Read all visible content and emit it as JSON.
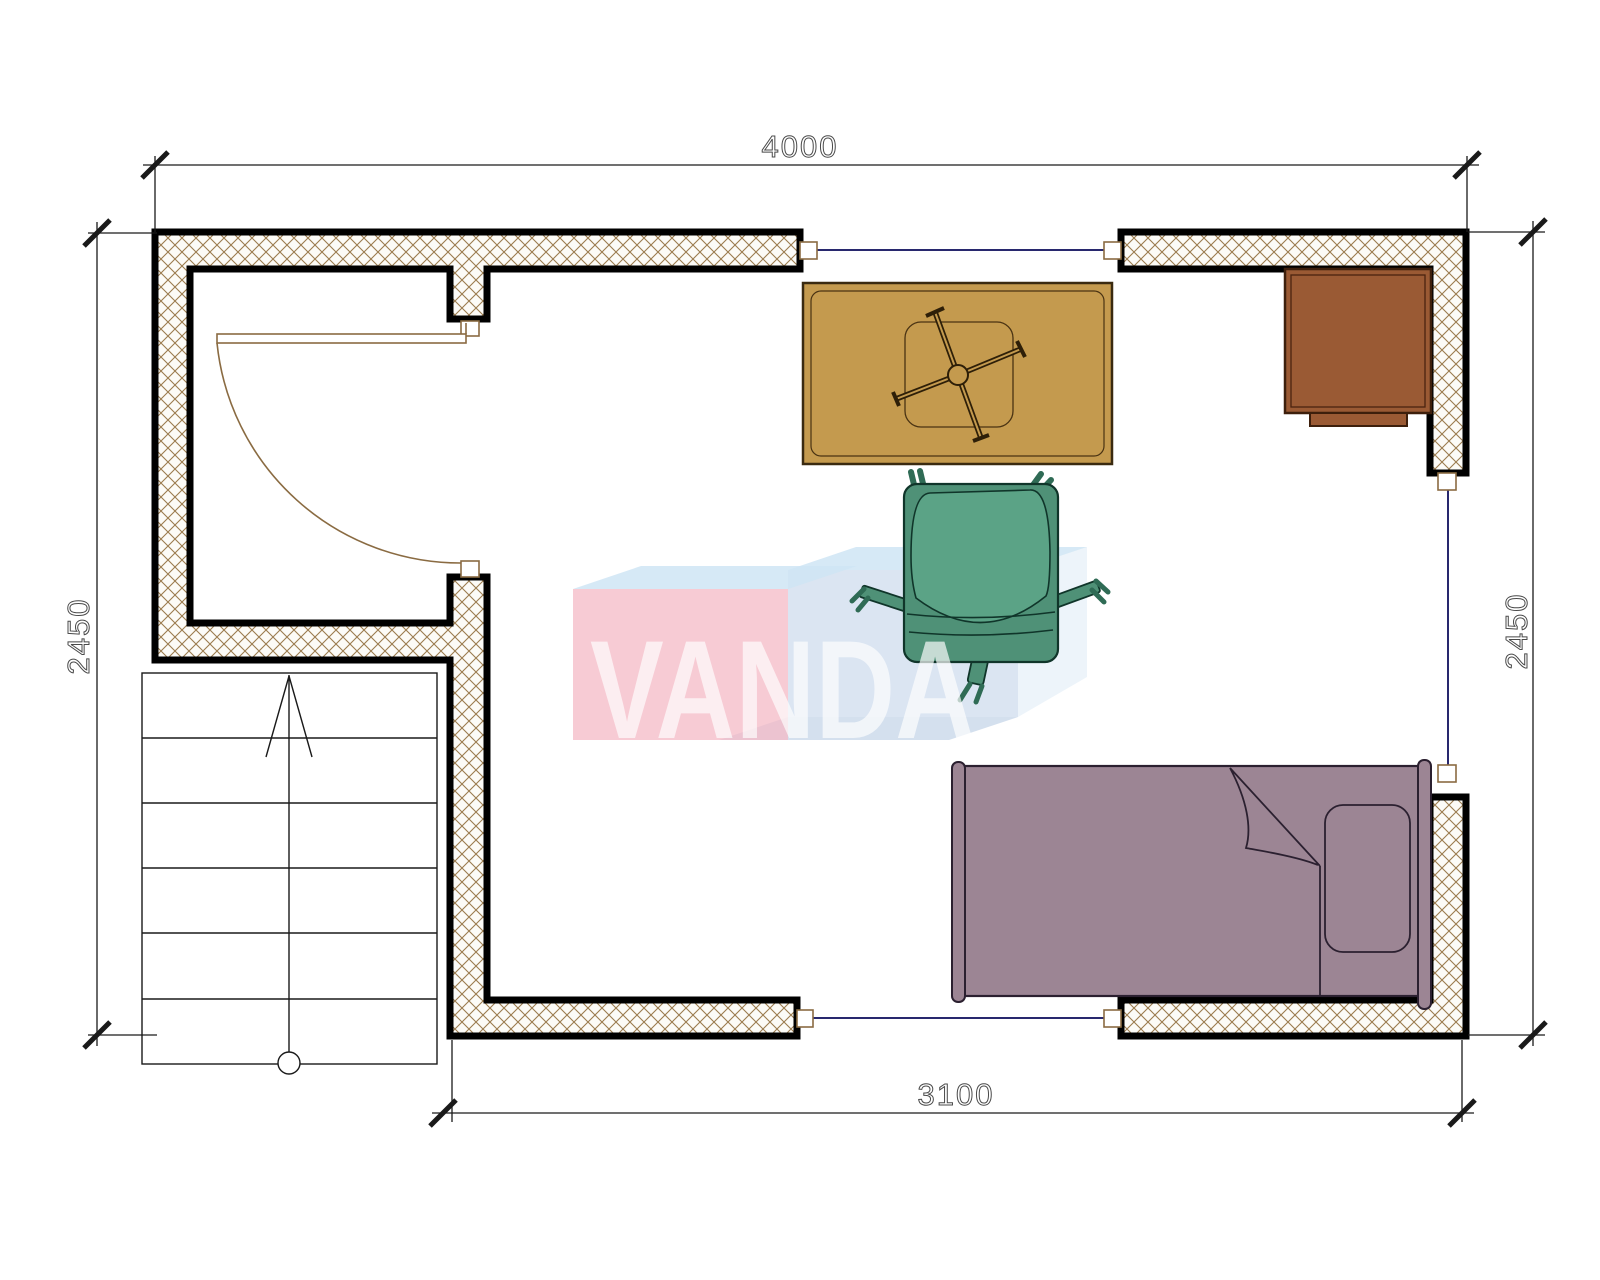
{
  "dimensions": {
    "top": "4000",
    "bottom": "3100",
    "left": "2450",
    "right": "2450"
  },
  "watermark": {
    "text": "VANDA",
    "front_pink": "#f4bac6",
    "front_blue": "#c3d4e9",
    "top_light_blue": "#cfe5f4",
    "side_blue": "#dce9f5",
    "bottom_blue": "#b7cbe3"
  },
  "colors": {
    "wall_outline": "#000000",
    "wall_hatch": "#9b7b4e",
    "wall_fill": "#fcfbf7",
    "opening_line": "#28286e",
    "door_frame": "#8a6b42",
    "dimension_line": "#1a1a1a",
    "dimension_text": "#4a4a4a",
    "stair_line": "#1a1a1a",
    "table_fill": "#c49a4e",
    "table_line": "#3a2a10",
    "cabinet_fill": "#9a5a34",
    "cabinet_line": "#3d1f0c",
    "chair_fill": "#4f9177",
    "chair_back_fill": "#5ba386",
    "chair_line": "#10352a",
    "bed_fill": "#9c8594",
    "bed_line": "#2b2030"
  },
  "furniture": [
    "staircase",
    "entry-door",
    "desk-table",
    "office-chair",
    "bedside-cabinet",
    "single-bed"
  ]
}
